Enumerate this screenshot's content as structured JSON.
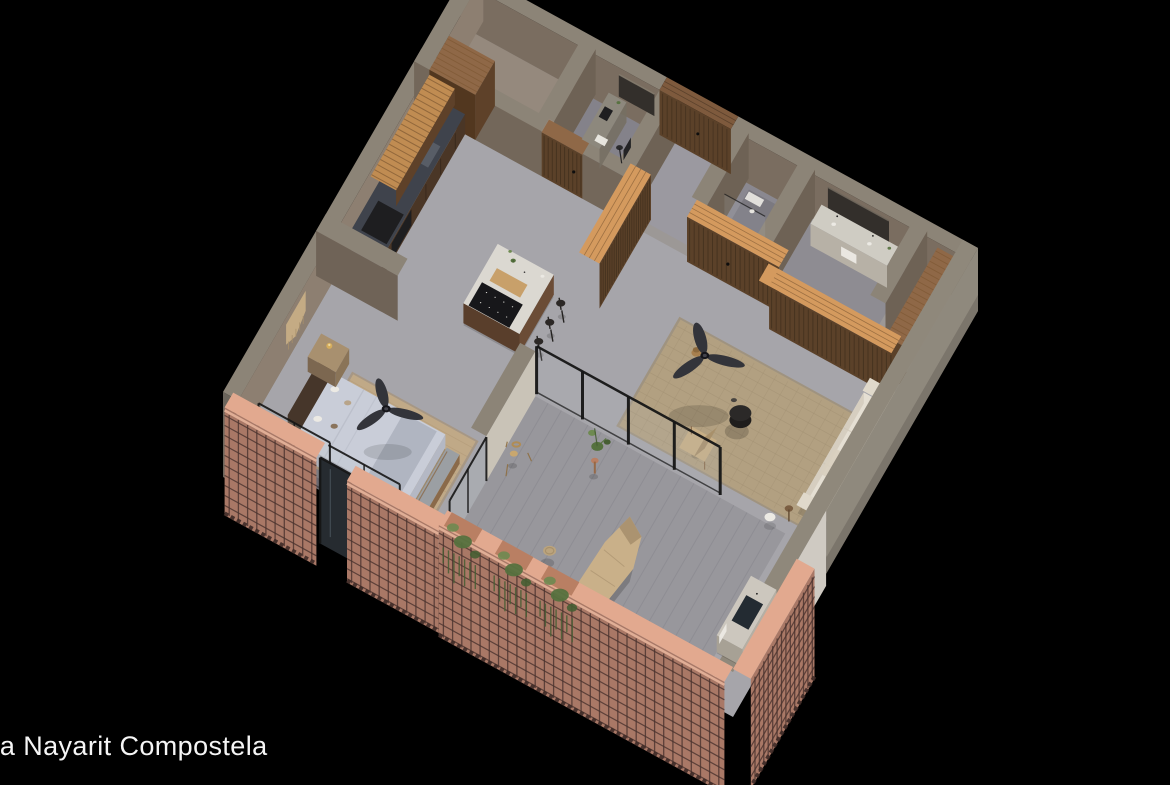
{
  "caption": {
    "text": "ta Nayarit Compostela"
  },
  "scene": {
    "type": "axonometric-floorplan-render",
    "project": "Nayarit Compostela",
    "rooms": [
      "entry",
      "storage-room",
      "study",
      "shower-room",
      "bathroom",
      "closet-room",
      "kitchen",
      "dining-area",
      "living-room",
      "bedroom",
      "terrace",
      "outdoor-kitchenette"
    ],
    "furniture": [
      "kitchen-island-with-cooktop",
      "bar-stools",
      "ceiling-fans",
      "double-bed",
      "foot-bench",
      "nightstand-with-lamp",
      "macrame-wall-hanging",
      "sofa-with-cushions",
      "round-coffee-table",
      "lounge-chair",
      "jute-rugs",
      "wishbone-chair",
      "daybed-lounger",
      "woven-poufs",
      "hanging-planters",
      "vanity-with-mirror",
      "desk-with-chair",
      "glass-sliding-doors",
      "brick-lattice-walls",
      "cat-figurine"
    ]
  },
  "colors": {
    "bg": "#000000",
    "caption": "#f5f5f5",
    "floor": "#a6a5aa",
    "floorTop": "#91897f",
    "floorTaupe": "#95897d",
    "floorStudy": "#84828a",
    "floorEntry": "#9b99a0",
    "floorShower": "#8a8890",
    "floorBath": "#8e8c92",
    "floorRoomR": "#968d82",
    "deck": "#98979c",
    "deckLine": "#86858d",
    "rug": "#b2a081",
    "rugLine": "#9c8b6e",
    "rugBed": "#c0a987",
    "rugBedLine": "#a78e6c",
    "wallTop": "#8c8477",
    "wallIn": "#7a6d60",
    "wallInL": "#8d7f71",
    "wallDark": "#6e6255",
    "wallFront": "#73675a",
    "outer": "#8f897d",
    "outerTop": "#8f887b",
    "outerWhite": "#cfcac2",
    "stub": "#6b655c",
    "woodTop": "#d49a5e",
    "wood": "#5b4129",
    "woodStripe": "#3a2a1a",
    "woodMid": "#6e4f38",
    "woodBright": "#c08c52",
    "woodBstripe": "#7a5530",
    "woodEdge": "#5e4129",
    "woodDeep": "#52371f",
    "woodLight": "#8f6847",
    "counterDark": "#3f434c",
    "cabinet": "#4a3626",
    "appliance": "#1e1e20",
    "islandTop": "#dbd8d1",
    "islandSide": "#6b4c36",
    "islandSideD": "#593e2b",
    "cooktop": "#17171a",
    "tray": "#c8a06a",
    "stool": "#2c2826",
    "legWood": "#7a5a3a",
    "cream": "#e5dfd3",
    "creamD": "#d6cec0",
    "white": "#eceae4",
    "pillowTan": "#b8a489",
    "chevron": "#8a745c",
    "duvet": "#c9cdd8",
    "duvetSide": "#b4b8c4",
    "duvetFront": "#a9adb9",
    "blanket": "#b0b5c1",
    "bench": "#9b9fa3",
    "benchWood": "#8a6a4a",
    "night": "#a8906f",
    "nightSide": "#8a7458",
    "brass": "#d5ad5c",
    "headboard": "#46362a",
    "charcoal": "#2b2928",
    "fan": "#33343a",
    "mirror": "#332f2b",
    "brick": "#a97866",
    "brickGrid": "#4a332e",
    "brickCap": "#e2a98f",
    "doorGlass": "#262b30",
    "glass": "#b9c2c6",
    "frame": "#161616",
    "green": "#55713e",
    "greenL": "#6e8a50",
    "greenD": "#465e33",
    "pot": "#b97f63",
    "tan": "#c7ae85",
    "tanD": "#a8906b",
    "pouf": "#bba47e",
    "lounger": "#c9b089",
    "loungerD": "#ab9370",
    "kitTop": "#ccc7be",
    "kitSide": "#b5afa4",
    "sinkDark": "#232b32",
    "shadow": "#000000"
  }
}
